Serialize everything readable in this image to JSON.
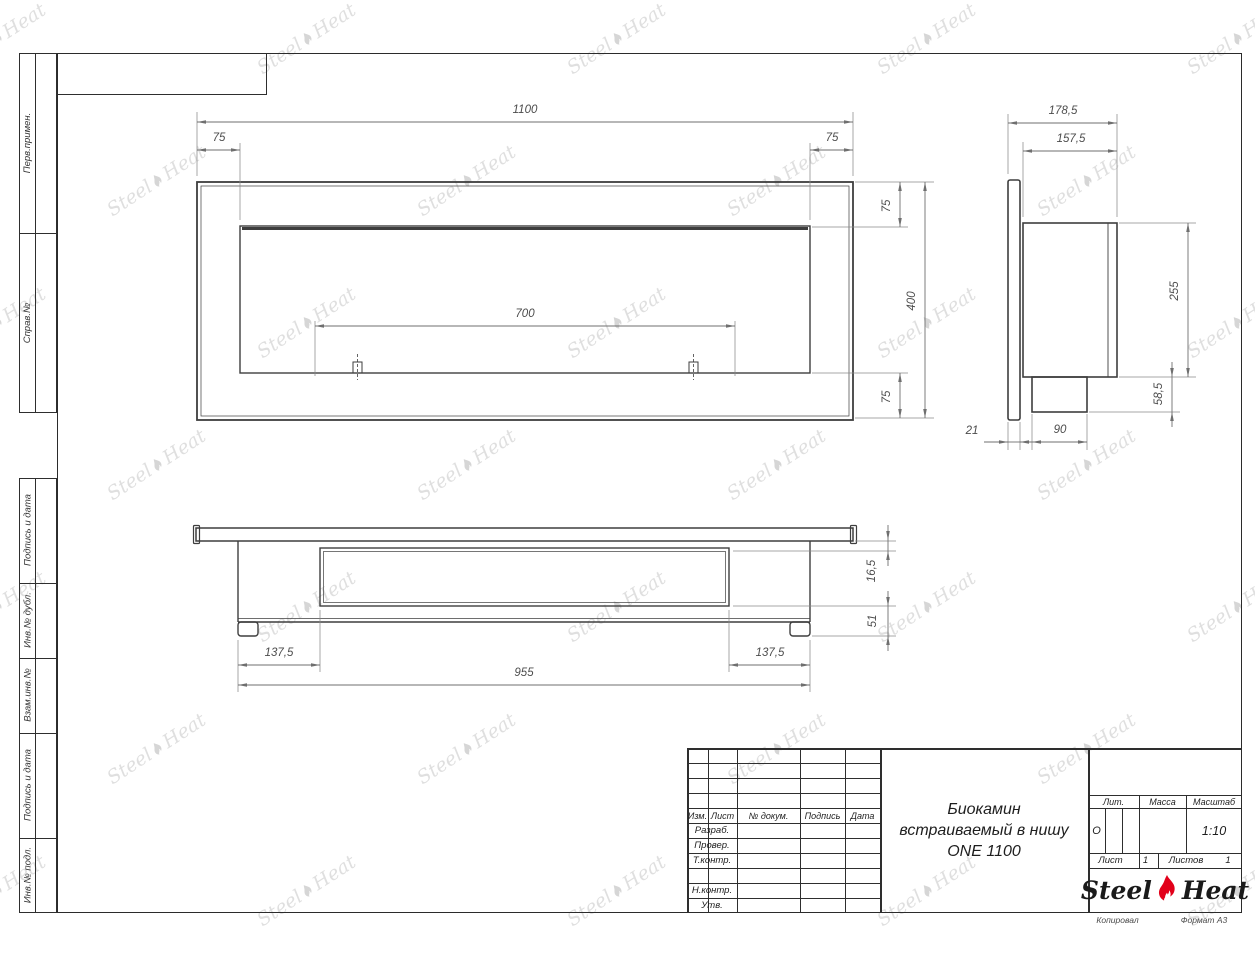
{
  "margin_labels": {
    "perv_primen": "Перв.примен.",
    "sprav_no": "Справ.№",
    "podpis_data_1": "Подпись и дата",
    "inv_dubl": "Инв.№ дубл.",
    "vzam_inv": "Взам.инв.№",
    "podpis_data_2": "Подпись и дата",
    "inv_podl": "Инв.№ подл."
  },
  "dimensions": {
    "front_width": "1100",
    "front_margin_left": "75",
    "front_margin_right": "75",
    "burner_width": "700",
    "front_margin_top": "75",
    "front_height": "400",
    "front_margin_bottom": "75",
    "side_depth_total": "178,5",
    "side_depth_body": "157,5",
    "side_height_body": "255",
    "side_height_lower": "58,5",
    "side_flange_thickness": "21",
    "side_box_width": "90",
    "bottom_inset_left": "137,5",
    "bottom_body_width": "955",
    "bottom_inset_right": "137,5",
    "bottom_plate_offset": "16,5",
    "bottom_lower_height": "51"
  },
  "title_block": {
    "col_izm": "Изм.",
    "col_list": "Лист",
    "col_doc": "№ докум.",
    "col_sign": "Подпись",
    "col_date": "Дата",
    "row_razrab": "Разраб.",
    "row_prover": "Провер.",
    "row_tkontr": "Т.контр.",
    "row_nkontr": "Н.контр.",
    "row_utv": "Утв.",
    "title_line1": "Биокамин",
    "title_line2": "встраиваемый в нишу",
    "title_line3": "ONE 1100",
    "lit_header": "Лит.",
    "massa_header": "Масса",
    "masshtab_header": "Масштаб",
    "lit_value": "О",
    "scale_value": "1:10",
    "list_label": "Лист",
    "list_value": "1",
    "listov_label": "Листов",
    "listov_value": "1",
    "logo_steel": "Steel",
    "logo_heat": "Heat"
  },
  "footer": {
    "kopiroval": "Копировал",
    "format": "Формат А3"
  },
  "watermark": {
    "text_left": "Steel",
    "text_right": "Heat"
  },
  "colors": {
    "flame_red": "#e2001a",
    "drawing_line": "#3e3e3e",
    "dim_line": "#6f6f6f"
  }
}
